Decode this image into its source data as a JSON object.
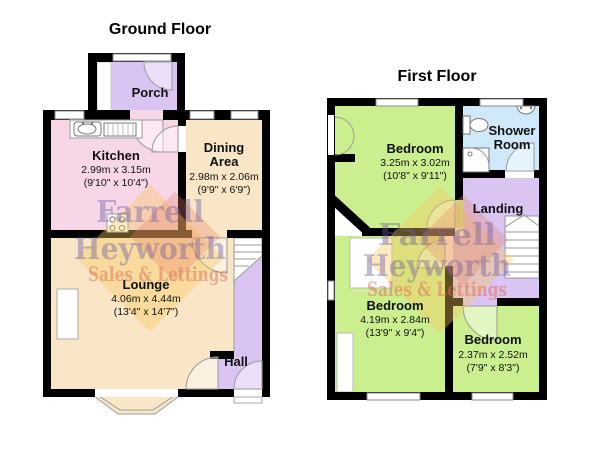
{
  "ground_floor": {
    "title": "Ground Floor",
    "rooms": {
      "porch": {
        "name": "Porch"
      },
      "kitchen": {
        "name": "Kitchen",
        "metric": "2.99m x 3.15m",
        "imperial": "(9'10\" x 10'4\")"
      },
      "dining": {
        "name_line1": "Dining",
        "name_line2": "Area",
        "metric": "2.98m x 2.06m",
        "imperial": "(9'9\" x 6'9\")"
      },
      "lounge": {
        "name": "Lounge",
        "metric": "4.06m x 4.44m",
        "imperial": "(13'4\" x 14'7\")"
      },
      "hall": {
        "name": "Hall"
      }
    }
  },
  "first_floor": {
    "title": "First Floor",
    "rooms": {
      "bedroom1": {
        "name": "Bedroom",
        "metric": "3.25m x 3.02m",
        "imperial": "(10'8\" x 9'11\")"
      },
      "shower": {
        "name_line1": "Shower",
        "name_line2": "Room"
      },
      "landing": {
        "name": "Landing"
      },
      "bedroom2": {
        "name": "Bedroom",
        "metric": "4.19m x 2.84m",
        "imperial": "(13'9\" x 9'4\")"
      },
      "bedroom3": {
        "name": "Bedroom",
        "metric": "2.37m x 2.52m",
        "imperial": "(7'9\" x 8'3\")"
      }
    }
  },
  "watermark": {
    "line1": "Farrell",
    "line2": "Heyworth",
    "line3": "Sales & Lettings",
    "text_purple": "rgba(110,94,162,0.42)",
    "text_orange": "rgba(228,105,85,0.5)"
  },
  "colors": {
    "wall": "#000000",
    "room_pink": "#f7d6e8",
    "room_tan": "#f8e6c6",
    "room_purple": "#d9c4f2",
    "room_green": "#cbee8f",
    "room_blue": "#cfe9fa",
    "logo_yellow": "rgba(246,199,92,0.38)",
    "logo_salmon": "rgba(233,125,100,0.30)"
  }
}
